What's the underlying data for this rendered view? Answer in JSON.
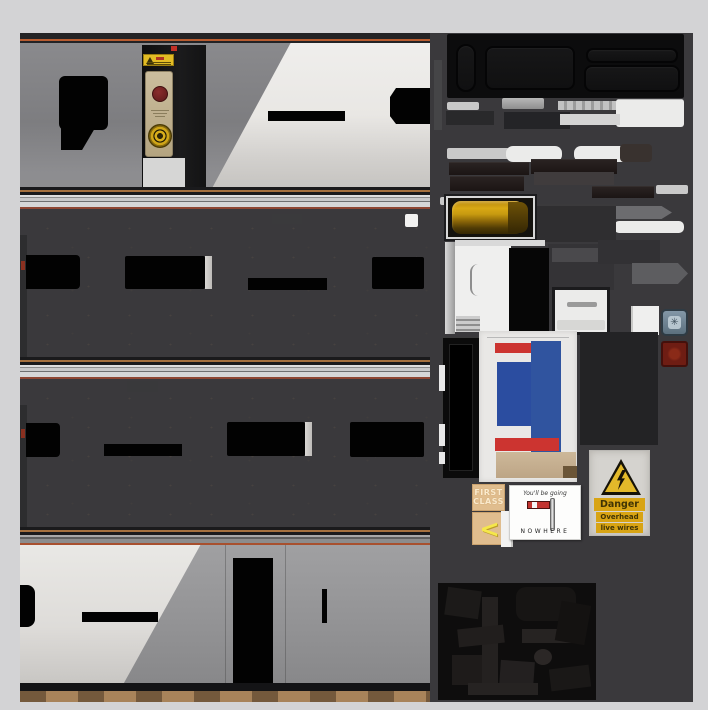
{
  "window": {
    "description_label": "train texture atlas sheet"
  },
  "signs": {
    "danger": {
      "title": "Danger",
      "line1": "Overhead",
      "line2": "live wires"
    },
    "first_class": {
      "line1": "FIRST",
      "line2": "CLASS"
    },
    "nowhere": {
      "top_text": "You'll be going",
      "bottom_text": "NOWHERE"
    },
    "chevron_glyph": "<"
  },
  "buttons": {
    "door_open_glyph": "✳"
  },
  "colors": {
    "page_background": "#d3d3d5",
    "atlas_background": "#3a393c",
    "car_body_white": "#e9e8e5",
    "window_black": "#020202",
    "roof_tan_line": "#a5713f",
    "cantrail_red_line": "#8f4632",
    "amber_handle": "#d8a814",
    "door_blue": "#2b4da0",
    "door_stripe_red": "#cc3430",
    "danger_yellow": "#e3b92a",
    "danger_label_yellow": "#d8a414",
    "first_class_tan": "#e0bd8e",
    "chevron_yellow": "#f5e74a",
    "door_button_blue": "#7e93a3",
    "door_button_red": "#6e1d13",
    "brake_panel_tan": "#c3b392",
    "valve_yellow": "#cfa518"
  }
}
